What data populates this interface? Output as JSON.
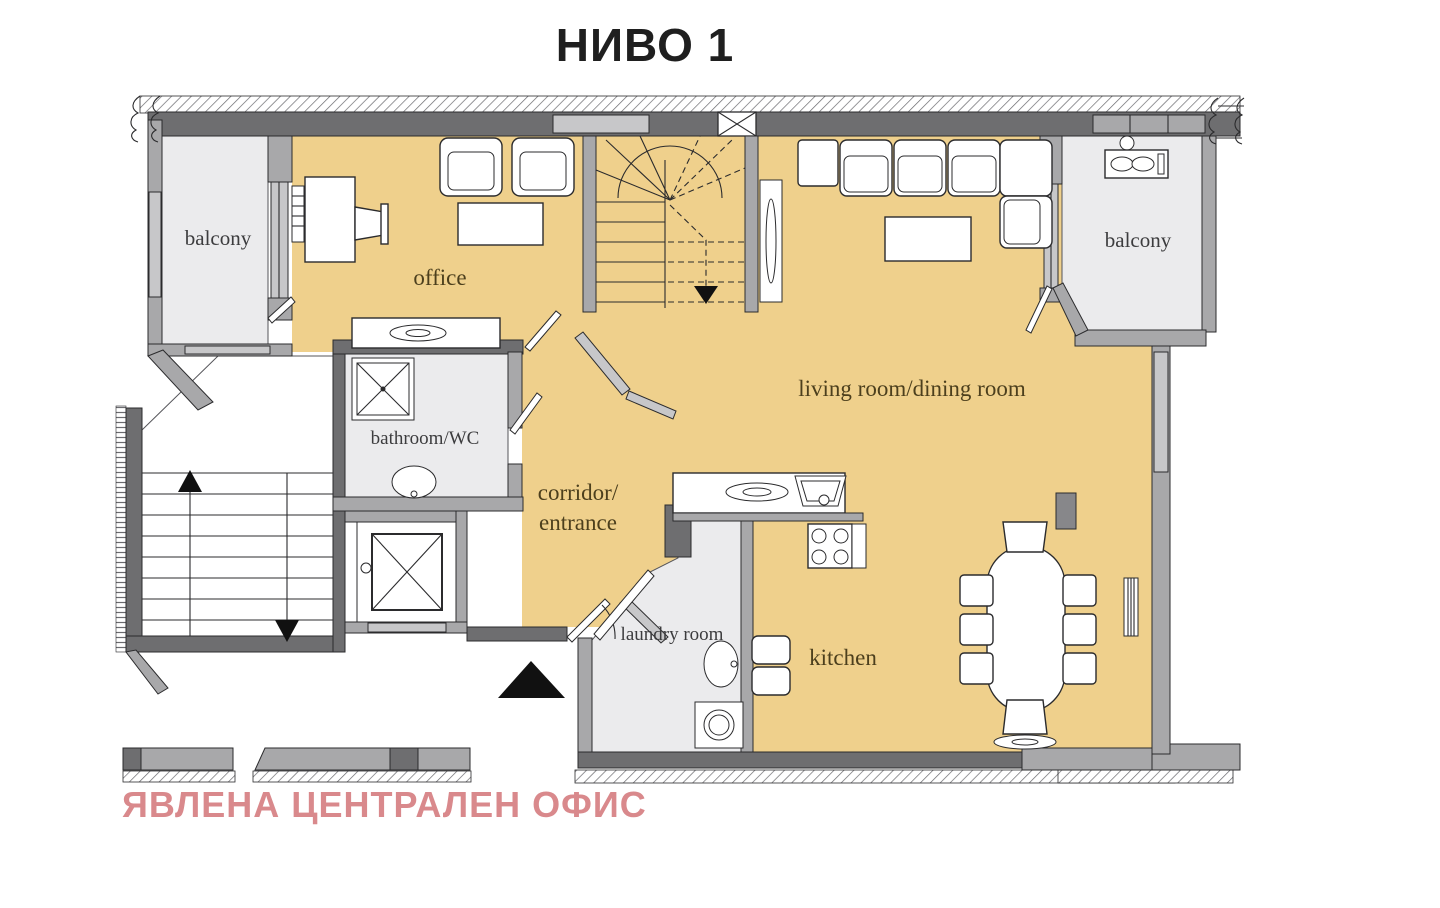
{
  "title": "НИВО 1",
  "watermark": "ЯВЛЕНА ЦЕНТРАЛЕН ОФИС",
  "rooms": {
    "balcony_left": "balcony",
    "office": "office",
    "living_dining": "living room/dining room",
    "balcony_right": "balcony",
    "bathroom": "bathroom/WC",
    "corridor": "corridor/",
    "entrance": "entrance",
    "laundry": "laundry room",
    "kitchen": "kitchen"
  },
  "colors": {
    "floor_tan": "#efd08c",
    "floor_light": "#ebebed",
    "wall_dark": "#6e6e70",
    "wall_medium": "#a8a8aa",
    "wall_light": "#c7c7c9",
    "label_tan_room": "#4c3f1d",
    "label_gray_room": "#3c3c3e",
    "title_color": "#1f1f1f",
    "watermark_color": "#d9898c"
  }
}
